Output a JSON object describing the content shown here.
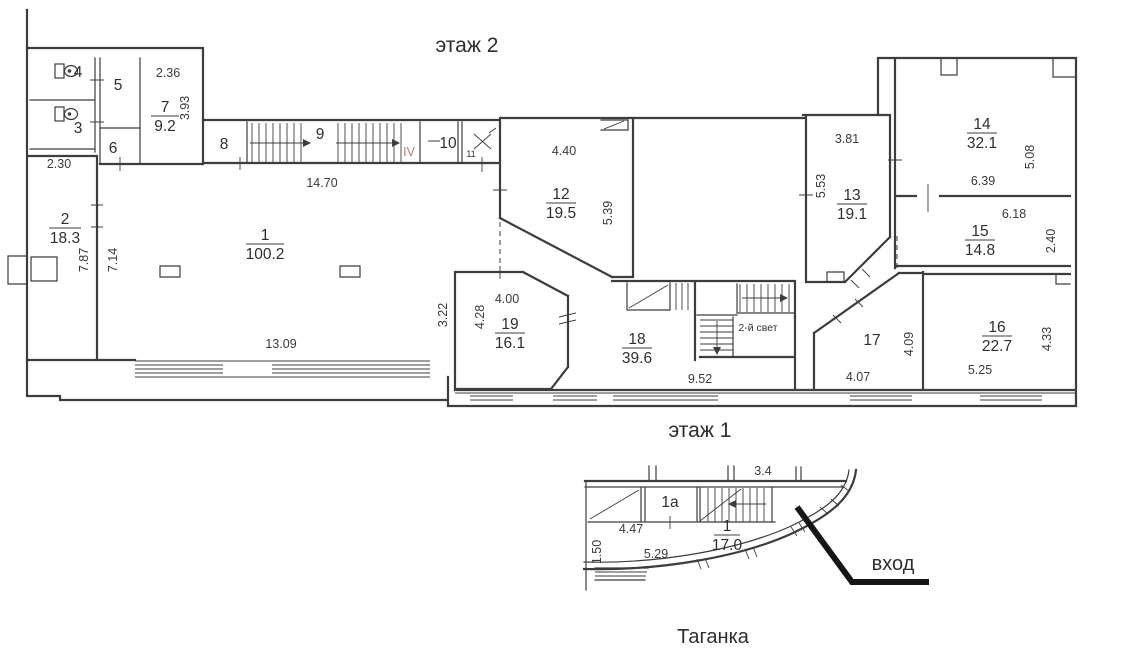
{
  "colors": {
    "line": "#3d3d3d",
    "accent_red": "#b97c74",
    "entrance_line": "#161616"
  },
  "floor2": {
    "title": "этаж 2",
    "rooms": {
      "r1": {
        "num": "1",
        "area": "100.2"
      },
      "r2": {
        "num": "2",
        "area": "18.3"
      },
      "r7": {
        "num": "7",
        "area": "9.2"
      },
      "r12": {
        "num": "12",
        "area": "19.5"
      },
      "r13": {
        "num": "13",
        "area": "19.1"
      },
      "r14": {
        "num": "14",
        "area": "32.1"
      },
      "r15": {
        "num": "15",
        "area": "14.8"
      },
      "r16": {
        "num": "16",
        "area": "22.7"
      },
      "r18": {
        "num": "18",
        "area": "39.6"
      },
      "r19": {
        "num": "19",
        "area": "16.1"
      }
    },
    "labels": {
      "wc_top": "4",
      "wc_bottom": "3",
      "r5": "5",
      "r6": "6",
      "r8": "8",
      "stairs": "9",
      "r10": "10",
      "r11": "11",
      "r17": "17",
      "stair_flight": "IV",
      "second_light": "2-й свет"
    },
    "dims": {
      "d2_36": "2.36",
      "d3_93": "3.93",
      "d2_30": "2.30",
      "d7_87": "7.87",
      "d7_14": "7.14",
      "d14_70": "14.70",
      "d13_09": "13.09",
      "d4_40": "4.40",
      "d5_39": "5.39",
      "d3_22": "3.22",
      "d4_28": "4.28",
      "d4_00": "4.00",
      "d9_52": "9.52",
      "d3_81": "3.81",
      "d5_53": "5.53",
      "d6_39": "6.39",
      "d5_08": "5.08",
      "d6_18": "6.18",
      "d2_40": "2.40",
      "d4_07": "4.07",
      "d4_09": "4.09",
      "d5_25": "5.25",
      "d4_33": "4.33"
    }
  },
  "floor1": {
    "title": "этаж 1",
    "rooms": {
      "r1": {
        "num": "1",
        "area": "17.0"
      }
    },
    "labels": {
      "r1a": "1a",
      "entrance": "вход",
      "station": "Таганка"
    },
    "dims": {
      "d3_4": "3.4",
      "d4_47": "4.47",
      "d1_50": "1.50",
      "d5_29": "5.29"
    }
  }
}
